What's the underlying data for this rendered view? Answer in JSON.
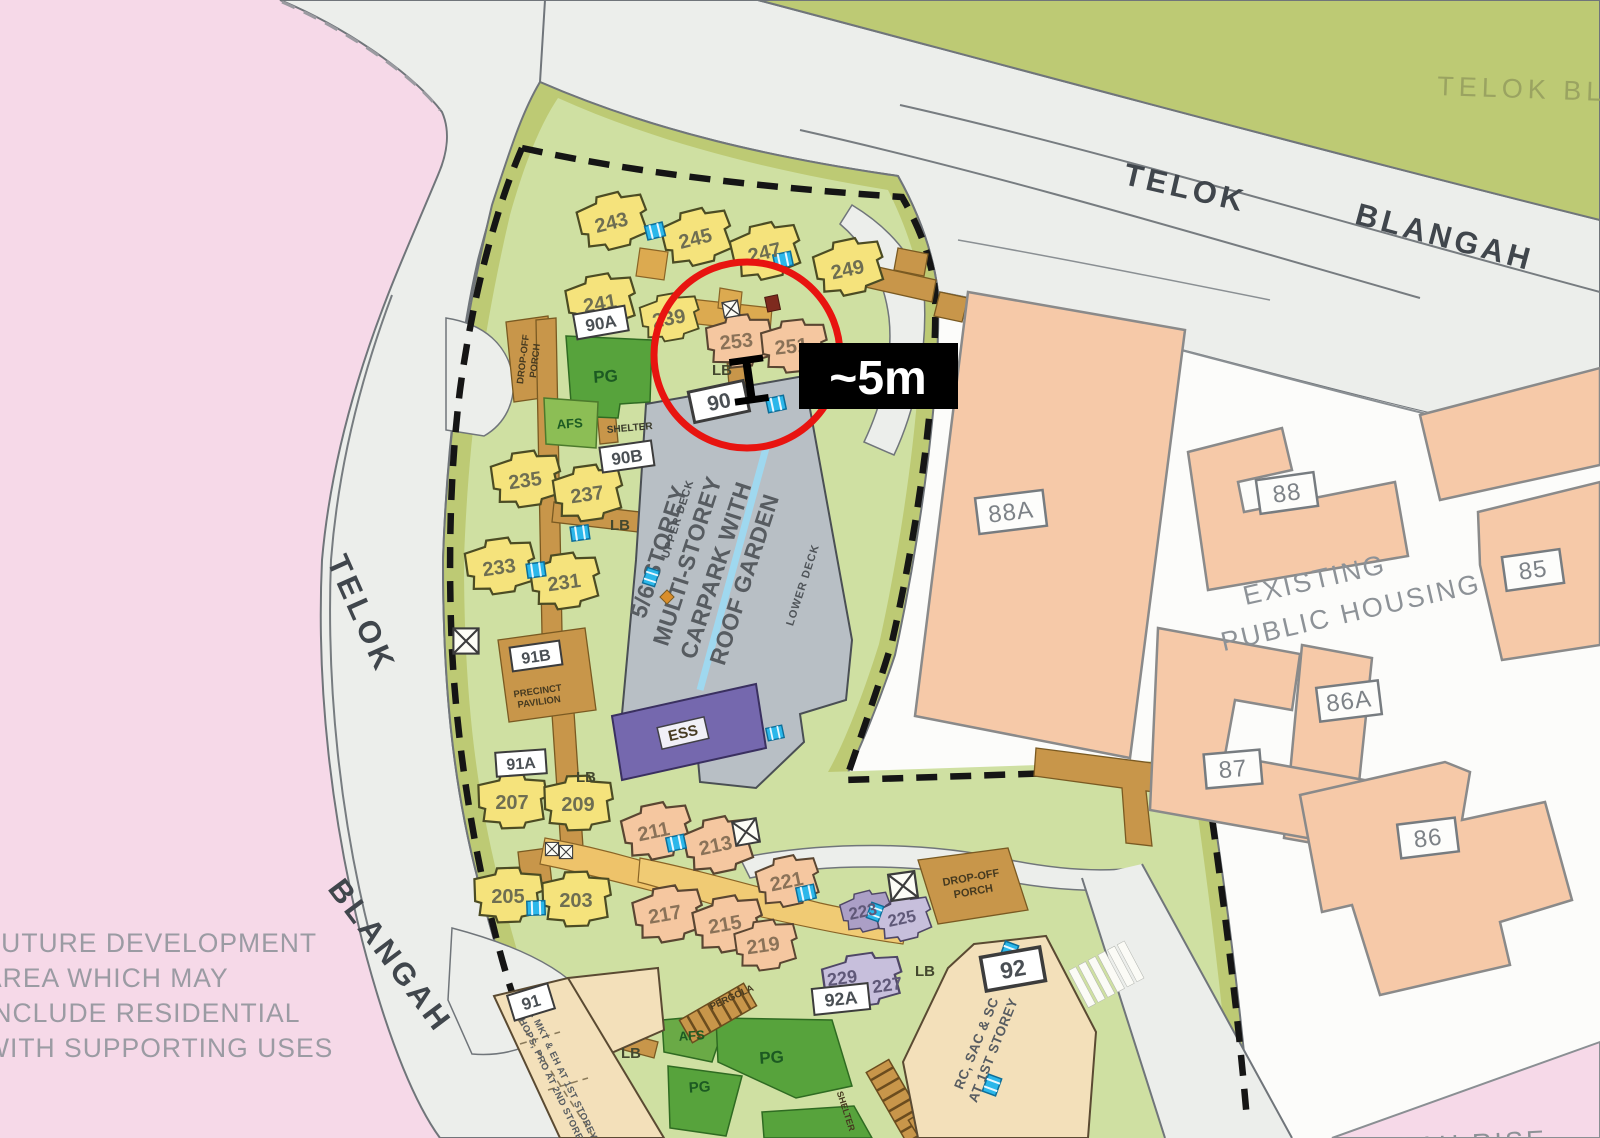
{
  "annotation": {
    "distance": "~5m"
  },
  "roads": {
    "telok_upper": "TELOK",
    "blangah_upper": "BLANGAH",
    "telok_left": "TELOK",
    "blangah_left": "BLANGAH",
    "corner_cut": "TELOK  BL",
    "bottom_right_cut": "BLANGAH RISE"
  },
  "notes": {
    "future_dev": [
      "FUTURE DEVELOPMENT",
      "AREA WHICH MAY",
      "INCLUDE RESIDENTIAL",
      "WITH SUPPORTING USES"
    ],
    "existing": [
      "EXISTING",
      "PUBLIC HOUSING"
    ]
  },
  "precincts": {
    "p90": "90",
    "p90A": "90A",
    "p90B": "90B",
    "p91": "91",
    "p91A": "91A",
    "p91B": "91B",
    "p92": "92",
    "p92A": "92A"
  },
  "existing_blocks": {
    "b85": "85",
    "b86": "86",
    "b86A": "86A",
    "b87": "87",
    "b88": "88",
    "b88A": "88A"
  },
  "blocks": {
    "b203": "203",
    "b205": "205",
    "b207": "207",
    "b209": "209",
    "b211": "211",
    "b213": "213",
    "b215": "215",
    "b217": "217",
    "b219": "219",
    "b221": "221",
    "b223": "223",
    "b225": "225",
    "b227": "227",
    "b229": "229",
    "b231": "231",
    "b233": "233",
    "b235": "235",
    "b237": "237",
    "b239": "239",
    "b241": "241",
    "b243": "243",
    "b245": "245",
    "b247": "247",
    "b249": "249",
    "b251": "251",
    "b253": "253"
  },
  "carpark": {
    "lines": [
      "5/6 STOREY",
      "MULTI-STOREY",
      "CARPARK WITH",
      "ROOF GARDEN"
    ],
    "upper_deck": "UPPER DECK",
    "lower_deck": "LOWER DECK"
  },
  "facilities": {
    "pg": "PG",
    "afs": "AFS",
    "lb": "LB",
    "ess": "ESS",
    "shelter": "SHELTER",
    "pergola": "PERGOLA",
    "precinct_pavilion": [
      "PRECINCT",
      "PAVILION"
    ],
    "drop_off_porch": [
      "DROP-OFF",
      "PORCH"
    ],
    "block92_use": [
      "RC, SAC & SC",
      "AT 1ST STOREY"
    ],
    "block91_use": [
      "S. MKT & EH AT 1ST STOREY",
      "SHOPS, PRO AT 2ND STOREY"
    ]
  },
  "colors": {
    "highlight_circle": "#e81410",
    "annotation_bg": "#000000",
    "annotation_text": "#ffffff",
    "estate_green": "#cfe0a2",
    "olive_band": "#bdca74",
    "carpark_fill": "#b8bfc5",
    "new_block_fill": "#f5c7a0",
    "old_block_fill": "#f5e37c",
    "existing_fill": "#f6c9a8",
    "lift_cyan": "#2bb7ea",
    "path_brown": "#c8964a",
    "ess_purple": "#7568ae",
    "pink_area": "#f6d9e8"
  }
}
